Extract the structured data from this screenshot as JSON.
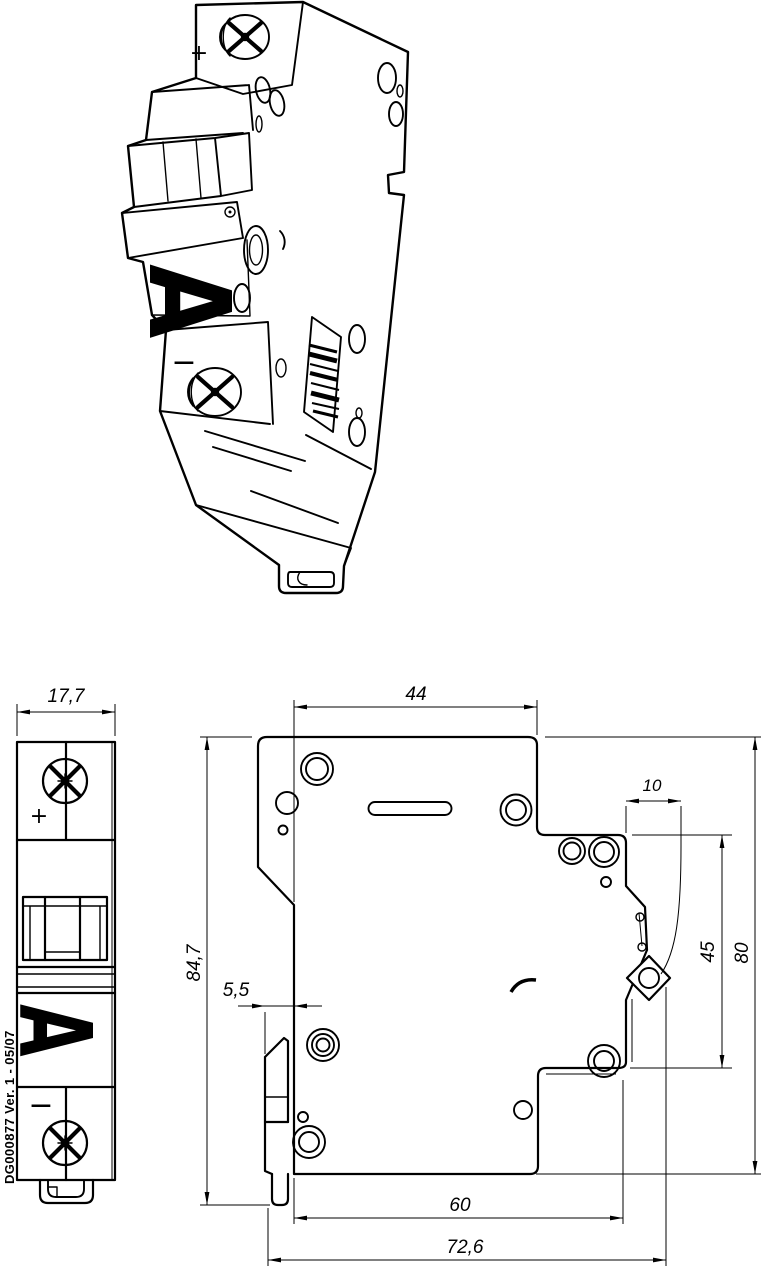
{
  "drawing": {
    "doc_reference": "DG000877 Ver. 1 - 05/07",
    "markings": {
      "plus": "+",
      "minus": "−",
      "letter_a": "A"
    },
    "dims": {
      "front_width": "17,7",
      "top_depth": "44",
      "terminal_depth": "10",
      "overall_height": "84,7",
      "clip_offset": "5,5",
      "upper_right_height": "45",
      "body_height": "80",
      "lower_depth": "60",
      "overall_depth": "72,6"
    },
    "colors": {
      "ink": "#000000",
      "paper": "#ffffff"
    }
  }
}
